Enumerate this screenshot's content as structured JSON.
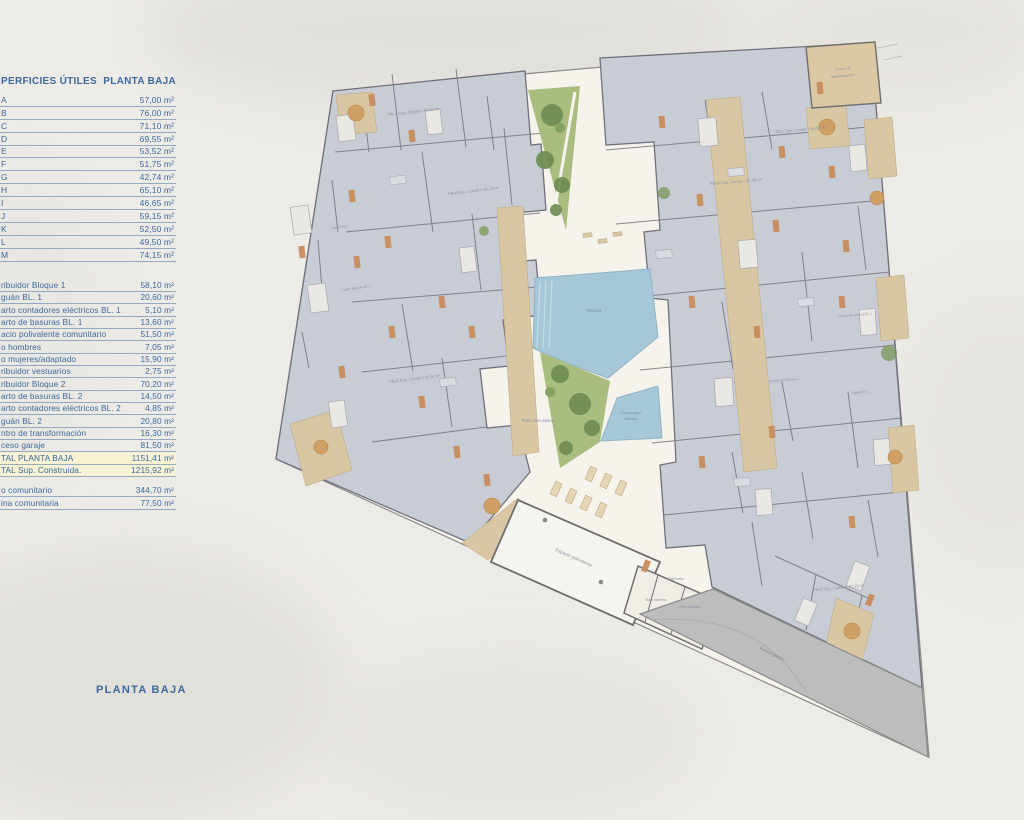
{
  "table": {
    "header": {
      "col1": "PERFICIES ÚTILES",
      "col2": "PLANTA BAJA"
    },
    "units": [
      {
        "label": "A",
        "value": "57,00 m²"
      },
      {
        "label": "B",
        "value": "76,00 m²"
      },
      {
        "label": "C",
        "value": "71,10 m²"
      },
      {
        "label": "D",
        "value": "69,55 m²"
      },
      {
        "label": "E",
        "value": "53,52 m²"
      },
      {
        "label": "F",
        "value": "51,75 m²"
      },
      {
        "label": "G",
        "value": "42,74 m²"
      },
      {
        "label": "H",
        "value": "65,10 m²"
      },
      {
        "label": "I",
        "value": "46,65 m²"
      },
      {
        "label": "J",
        "value": "59,15 m²"
      },
      {
        "label": "K",
        "value": "52,50 m²"
      },
      {
        "label": "L",
        "value": "49,50 m²"
      },
      {
        "label": "M",
        "value": "74,15 m²"
      }
    ],
    "common": [
      {
        "label": "ribuidor Bloque 1",
        "value": "58,10 m²"
      },
      {
        "label": "guán BL. 1",
        "value": "20,60 m²"
      },
      {
        "label": "arto contadores eléctricos BL. 1",
        "value": "5,10 m²"
      },
      {
        "label": "arto de basuras BL. 1",
        "value": "13,60 m²"
      },
      {
        "label": "acio polivalente comunitario",
        "value": "51,50 m²"
      },
      {
        "label": "o hombres",
        "value": "7,05 m²"
      },
      {
        "label": "o mujeres/adaptado",
        "value": "15,90 m²"
      },
      {
        "label": "ribuidor vestuarios",
        "value": "2,75 m²"
      },
      {
        "label": "ribuidor Bloque 2",
        "value": "70,20 m²"
      },
      {
        "label": "arto de basuras BL. 2",
        "value": "14,50 m²"
      },
      {
        "label": "arto contadores eléctricos BL. 2",
        "value": "4,85 m²"
      },
      {
        "label": "guán BL. 2",
        "value": "20,80 m²"
      },
      {
        "label": "ntro de transformación",
        "value": "16,30 m²"
      },
      {
        "label": "ceso garaje",
        "value": "81,50 m²"
      },
      {
        "label": "TAL PLANTA BAJA",
        "value": "1151,41 m²",
        "highlight": true
      },
      {
        "label": "TAL Sup. Construida.",
        "value": "1215,92 m²",
        "highlight": true
      }
    ],
    "community": [
      {
        "label": "o comunitario",
        "value": "344,70 m²"
      },
      {
        "label": "ina comunitaria",
        "value": "77,50 m²"
      }
    ]
  },
  "footer": {
    "title": "PLANTA BAJA"
  },
  "plan": {
    "labels": {
      "piscina": "Piscina",
      "piscina_elevada_1": "Piscina sobre",
      "piscina_elevada_2": "elevada",
      "patio": "Patio comunitario",
      "espacio": "Espacio polivalente",
      "distribuidor": "Distribuidor",
      "bano_hombres": "Baño hombres",
      "bano_adaptado": "Baño adaptado",
      "acceso": "Acceso garaje",
      "centro_1": "Centro de",
      "centro_2": "transformación",
      "zaguan1": "Zaguán Bl. 1",
      "basuras1": "Cuarto basuras Bl. 1",
      "dist2": "Distribuidor Bloque 2",
      "basuras2": "Cuarto de basuras Bl. 2",
      "zaguan2": "Zaguán Bl. 2",
      "pb_a": "PB-A Sup. Constr.= 67,65 m²",
      "pb_b": "PB-B Sup. Constr.= 82,20 m²",
      "pb_c": "PB-C Sup. Constr.= 81,52 m²",
      "pb_f": "PB-F Sup. Constr.= 61,25 m²",
      "pb_l": "PB-L Sup. Constr.= 53,99 m²",
      "pb_m": "PB-M Sup. Constr.= 80,20 m²"
    },
    "colors": {
      "accent_blue": "#3c69a0",
      "highlight": "#f7f2d3",
      "paper": "#edebe6",
      "courtyard": "#f5f3ec",
      "block_gray": "#c8ccd5",
      "wall_gray": "#70707a",
      "terrace_tan": "#d9c7a3",
      "pool_blue": "#a6c7d8",
      "garden_green": "#a9bd7f",
      "ramp_gray": "#bdbdbd"
    }
  }
}
